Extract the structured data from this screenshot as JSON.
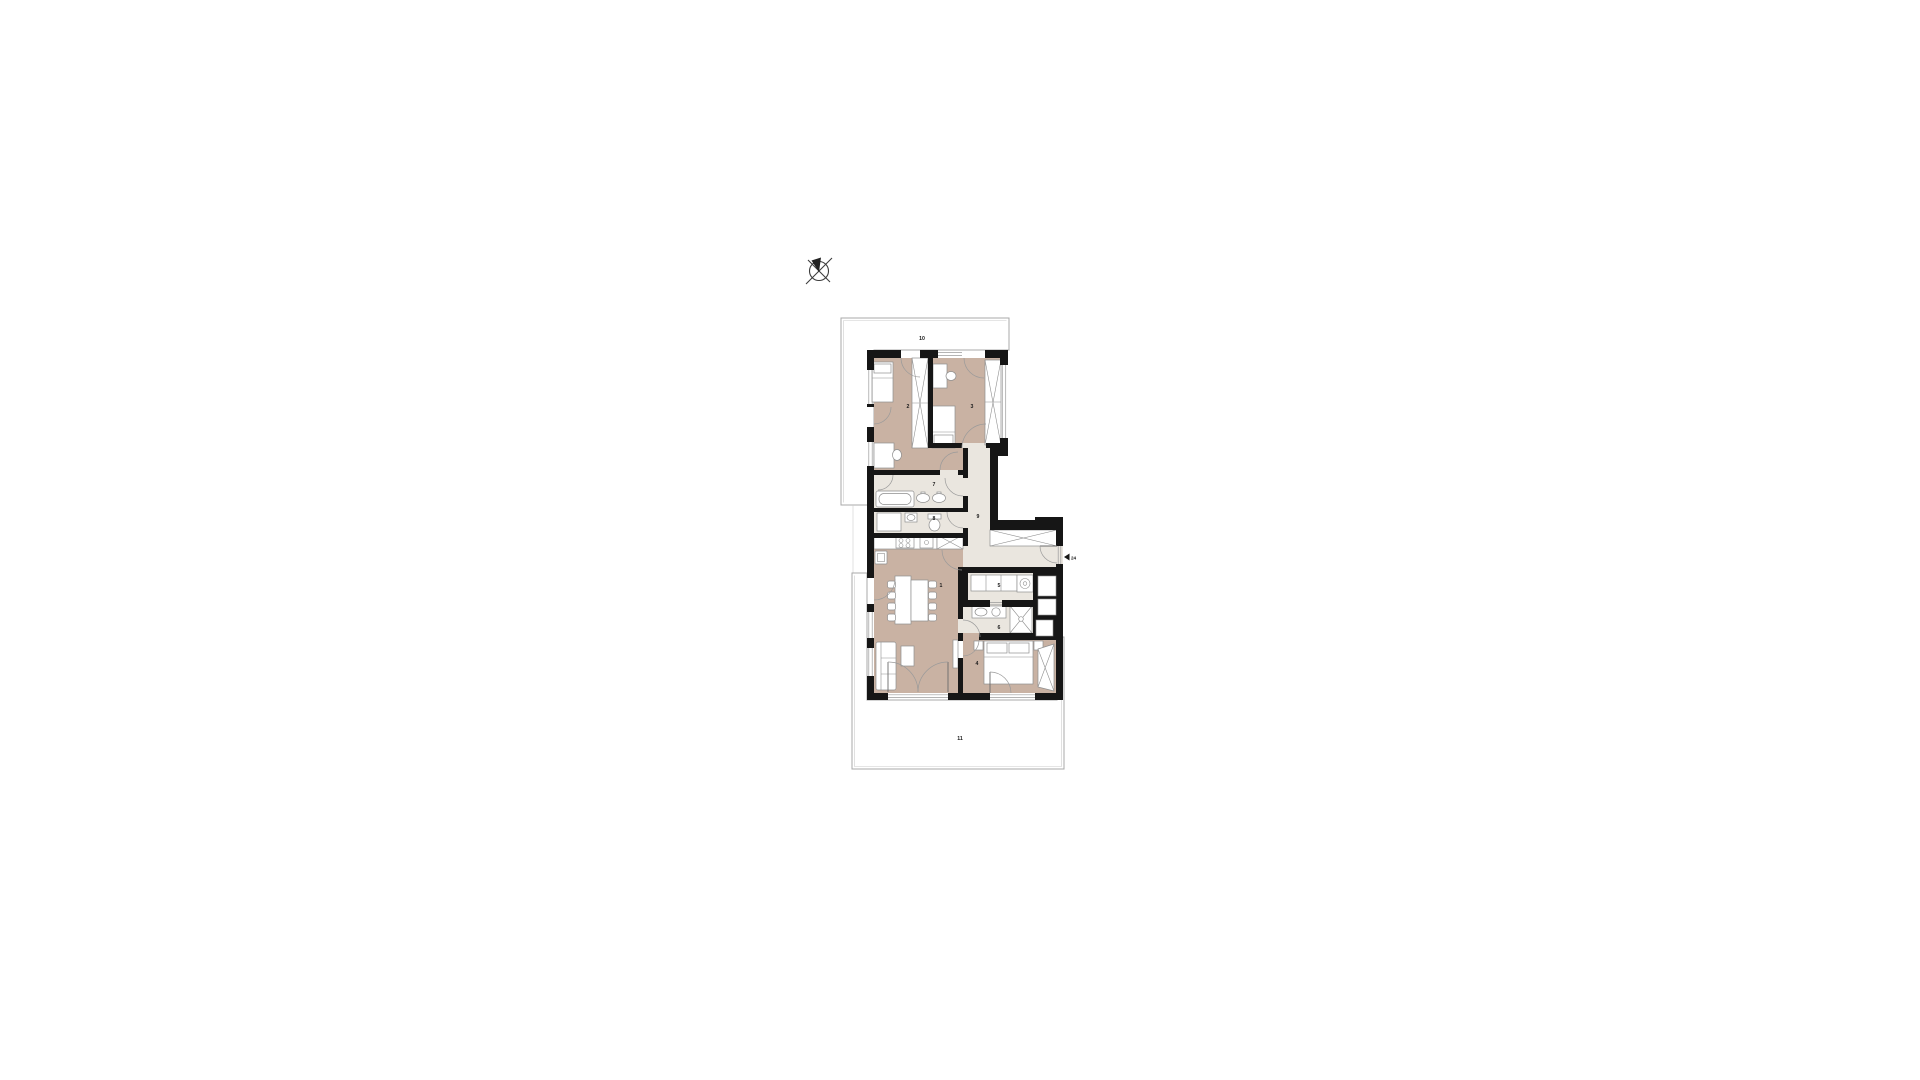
{
  "page": {
    "background": "#ffffff"
  },
  "plan": {
    "labels": {
      "r1": "1",
      "r2": "2",
      "r3": "3",
      "r4": "4",
      "r5": "5",
      "r6": "6",
      "r7": "7",
      "r8": "8",
      "r9": "9",
      "t10": "10",
      "t11": "11",
      "entrance": "24"
    },
    "colors": {
      "wall": "#161616",
      "room_floor": "#c9b2a3",
      "wet_floor": "#eae6df",
      "terrace_grid_line": "#e1ded8",
      "terrace_outline": "#a8a8a8",
      "furniture_stroke": "#8f8f8f",
      "door_arc": "#9a9a9a",
      "label_text": "#1a1a1a"
    },
    "icons": {
      "compass": "compass-rose-icon",
      "entrance_marker": "left-triangle-icon"
    }
  }
}
